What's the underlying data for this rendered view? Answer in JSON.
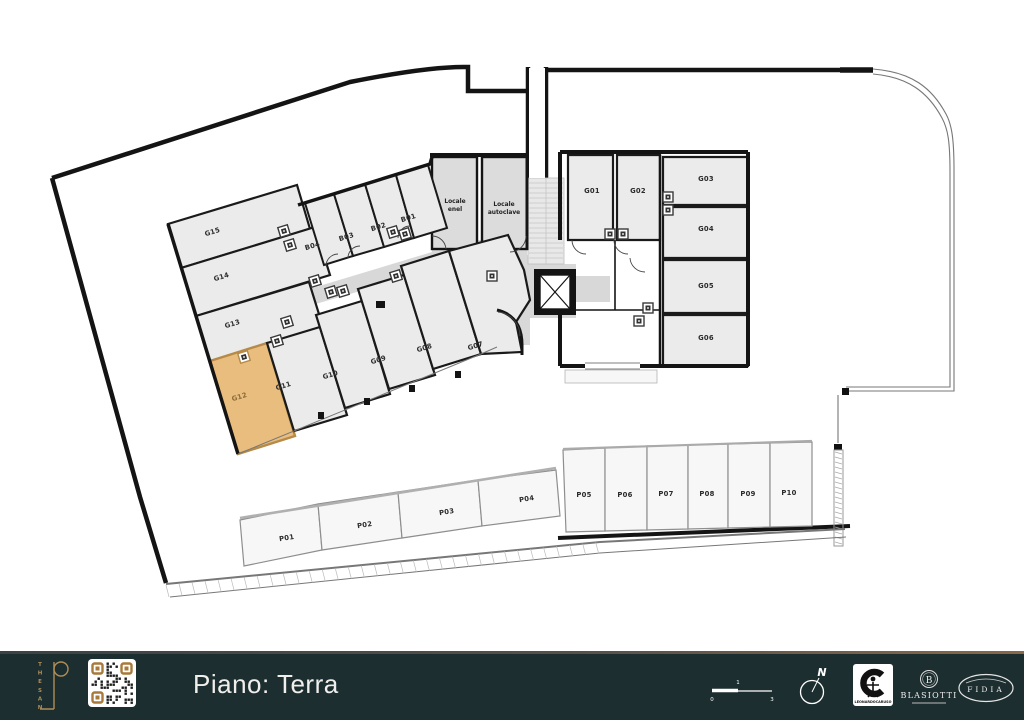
{
  "floor_plan": {
    "highlighted_unit": "G12",
    "highlight_fill": "#e9bd7e",
    "units": [
      {
        "id": "G15",
        "x": 213,
        "y": 234,
        "rot": -17
      },
      {
        "id": "G14",
        "x": 222,
        "y": 279,
        "rot": -17
      },
      {
        "id": "G13",
        "x": 233,
        "y": 326,
        "rot": -17
      },
      {
        "id": "G12",
        "x": 240,
        "y": 399,
        "rot": -17,
        "highlighted": true
      },
      {
        "id": "G11",
        "x": 284,
        "y": 388,
        "rot": -17
      },
      {
        "id": "G10",
        "x": 331,
        "y": 377,
        "rot": -17
      },
      {
        "id": "G09",
        "x": 379,
        "y": 362,
        "rot": -17
      },
      {
        "id": "G08",
        "x": 425,
        "y": 350,
        "rot": -17
      },
      {
        "id": "G07",
        "x": 476,
        "y": 348,
        "rot": -17
      },
      {
        "id": "B04",
        "x": 313,
        "y": 248,
        "rot": -17
      },
      {
        "id": "B03",
        "x": 347,
        "y": 239,
        "rot": -17
      },
      {
        "id": "B02",
        "x": 379,
        "y": 229,
        "rot": -17
      },
      {
        "id": "B01",
        "x": 409,
        "y": 220,
        "rot": -17
      },
      {
        "id": "G01",
        "x": 592,
        "y": 193,
        "rot": 0
      },
      {
        "id": "G02",
        "x": 638,
        "y": 193,
        "rot": 0
      },
      {
        "id": "G03",
        "x": 706,
        "y": 181,
        "rot": 0
      },
      {
        "id": "G04",
        "x": 706,
        "y": 231,
        "rot": 0
      },
      {
        "id": "G05",
        "x": 706,
        "y": 288,
        "rot": 0
      },
      {
        "id": "G06",
        "x": 706,
        "y": 340,
        "rot": 0
      },
      {
        "id": "P01",
        "x": 287,
        "y": 540,
        "rot": -9
      },
      {
        "id": "P02",
        "x": 365,
        "y": 527,
        "rot": -9
      },
      {
        "id": "P03",
        "x": 447,
        "y": 514,
        "rot": -9
      },
      {
        "id": "P04",
        "x": 527,
        "y": 501,
        "rot": -9
      },
      {
        "id": "P05",
        "x": 584,
        "y": 497,
        "rot": 0
      },
      {
        "id": "P06",
        "x": 625,
        "y": 497,
        "rot": 0
      },
      {
        "id": "P07",
        "x": 666,
        "y": 496,
        "rot": 0
      },
      {
        "id": "P08",
        "x": 707,
        "y": 496,
        "rot": 0
      },
      {
        "id": "P09",
        "x": 748,
        "y": 496,
        "rot": 0
      },
      {
        "id": "P10",
        "x": 789,
        "y": 495,
        "rot": 0
      }
    ],
    "technical_rooms": [
      {
        "id": "locale-enel",
        "lines": [
          "Locale",
          "enel"
        ],
        "x": 455,
        "y": 203
      },
      {
        "id": "locale-autoclave",
        "lines": [
          "Locale",
          "autoclave"
        ],
        "x": 504,
        "y": 206
      }
    ]
  },
  "footer": {
    "title": "Piano: Terra",
    "brand_name": "THESAN",
    "brand_color": "#b08d57",
    "background": "#1c2e2f",
    "scale_ticks": [
      "0",
      "1",
      "3"
    ],
    "compass_north_label": "N",
    "partner_logos": [
      {
        "name": "leonardo-caruso",
        "text": "LEONARDOCARUSO"
      },
      {
        "name": "blasiotti",
        "text": "BLASIOTTI"
      },
      {
        "name": "fidia",
        "text": "FIDIA"
      }
    ]
  }
}
